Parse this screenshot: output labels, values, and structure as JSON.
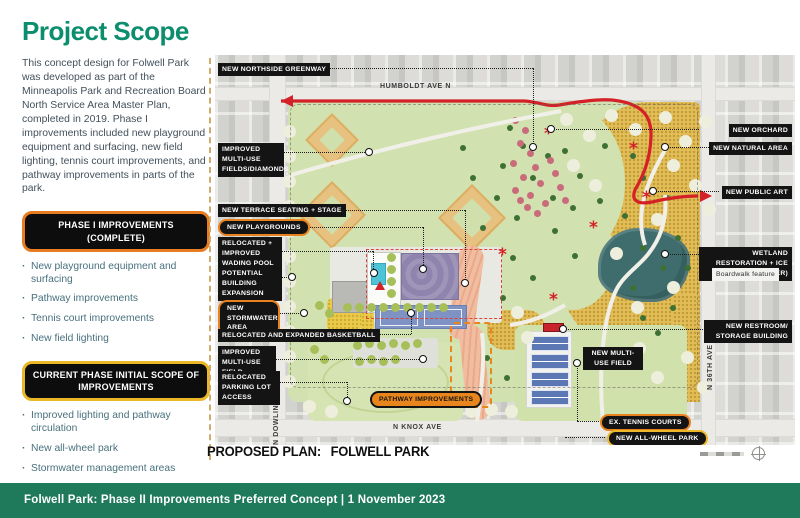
{
  "slide": {
    "title": "Project Scope",
    "intro": "This concept design for Folwell Park was developed as part of the Minneapolis Park and Recreation Board North Service Area Master Plan, completed in 2019. Phase I improvements included new playground equipment and surfacing, new field lighting, tennis court improvements, and pathway improvements in parts of the park."
  },
  "phase1": {
    "heading": "PHASE I IMPROVEMENTS (COMPLETE)",
    "items": [
      "New playground equipment and surfacing",
      "Pathway improvements",
      "Tennis court improvements",
      "New field lighting"
    ]
  },
  "current_phase": {
    "heading": "CURRENT PHASE INITIAL SCOPE OF IMPROVEMENTS",
    "items": [
      "Improved lighting and pathway circulation",
      "New all-wheel park",
      "Stormwater management areas",
      "Improved picnic and seating areas"
    ]
  },
  "map": {
    "caption_prefix": "PROPOSED PLAN:",
    "caption_name": "FOLWELL PARK",
    "streets": {
      "north": "HUMBOLDT AVE N",
      "west": "N DOWLING AVE",
      "south": "N KNOX AVE",
      "east": "N 36TH AVE"
    },
    "labels": {
      "northside_greenway": "NEW NORTHSIDE GREENWAY",
      "multiuse_diamonds": "IMPROVED MULTI-USE FIELDS/DIAMONDS",
      "terrace_stage": "NEW TERRACE SEATING + STAGE",
      "playgrounds": "NEW PLAYGROUNDS",
      "wading_pool": "RELOCATED + IMPROVED WADING POOL",
      "building_expansion": "POTENTIAL BUILDING EXPANSION",
      "stormwater": "NEW STORMWATER AREA",
      "basketball": "RELOCATED AND EXPANDED BASKETBALL",
      "improved_field": "IMPROVED MULTI-USE FIELD",
      "parking": "RELOCATED PARKING LOT ACCESS",
      "pathway": "PATHWAY IMPROVEMENTS",
      "orchard": "NEW ORCHARD",
      "natural_area": "NEW NATURAL AREA",
      "public_art": "NEW PUBLIC ART",
      "wetland": "WETLAND RESTORATION + ICE SKATING (WINTER)",
      "boardwalk": "Boardwalk feature",
      "restroom": "NEW RESTROOM/ STORAGE BUILDING",
      "new_multiuse_field": "NEW MULTI-USE FIELD",
      "tennis": "EX. TENNIS COURTS",
      "all_wheel": "NEW ALL-WHEEL PARK"
    }
  },
  "footer": {
    "text": "Folwell Park: Phase II Improvements Preferred Concept  |  1 November 2023"
  },
  "colors": {
    "brand_teal": "#0c8e6e",
    "footer_green": "#1f7a5b",
    "accent_orange": "#e87c20",
    "accent_gold": "#eab827",
    "route_red": "#d42127",
    "park_green": "#d2e1b0",
    "natural_yellow": "#e3bd55",
    "pond_teal": "#3f6d6e"
  }
}
